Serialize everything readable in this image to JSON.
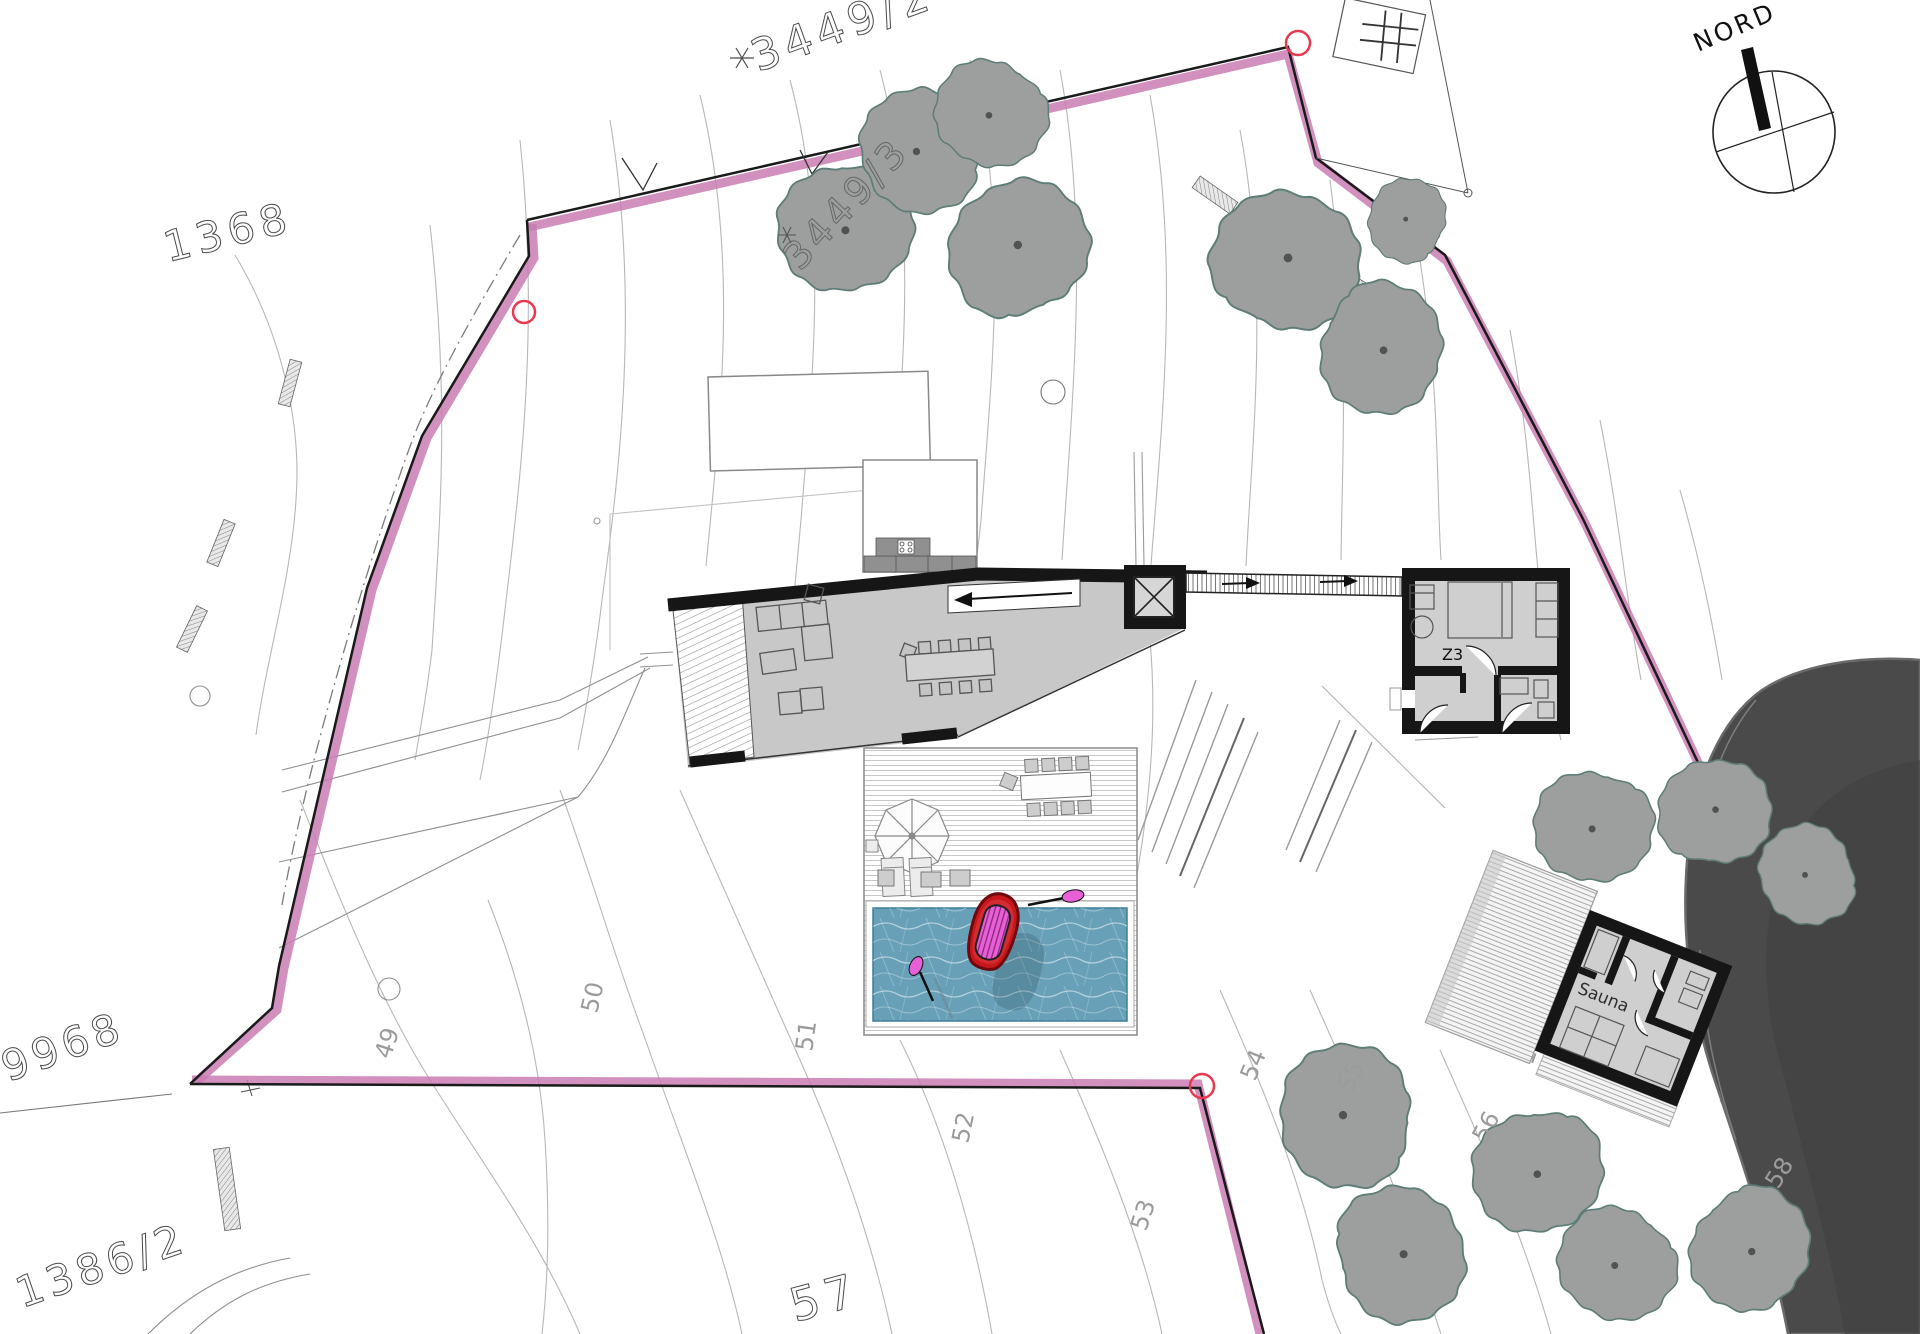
{
  "compass": {
    "label": "NORD"
  },
  "parcel_labels": [
    {
      "id": "3449-2",
      "text": "3449/2"
    },
    {
      "id": "3449-3",
      "text": "3449/3"
    },
    {
      "id": "1368",
      "text": "1368"
    },
    {
      "id": "9968",
      "text": "9968"
    },
    {
      "id": "1386-2",
      "text": "1386/2"
    },
    {
      "id": "57",
      "text": "57"
    }
  ],
  "contour_labels": [
    {
      "text": "49"
    },
    {
      "text": "50"
    },
    {
      "text": "51"
    },
    {
      "text": "52"
    },
    {
      "text": "53"
    },
    {
      "text": "54"
    },
    {
      "text": "55"
    },
    {
      "text": "56"
    },
    {
      "text": "58"
    },
    {
      "text": "13"
    }
  ],
  "room_labels": {
    "z3": "Z3",
    "sauna": "Sauna"
  },
  "colors": {
    "boundary_pink": "#c97cb2",
    "survey_red": "#e8384f",
    "water": "#68a0b8",
    "boat_red": "#c8161d",
    "boat_inner_red": "#d42a31",
    "boat_pink": "#e760d8",
    "shore_dark": "#4a4a4a",
    "tree_fill": "#9c9f9e",
    "tree_stroke": "#5e7d77"
  }
}
